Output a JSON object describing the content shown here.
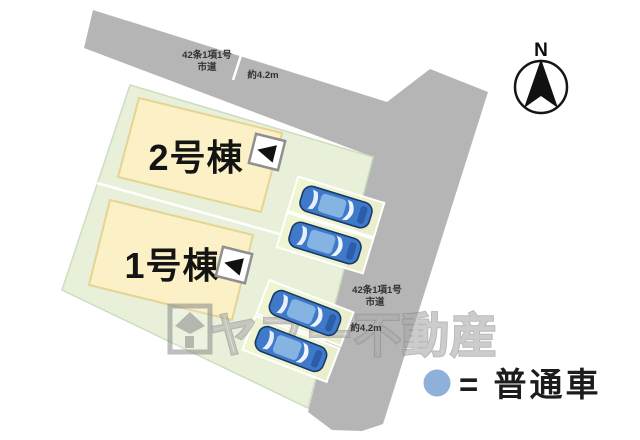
{
  "plan": {
    "buildings": [
      {
        "label": "2号棟"
      },
      {
        "label": "1号棟"
      }
    ],
    "roads": {
      "top": {
        "name_line1": "42条1項1号",
        "name_line2": "市道",
        "width": "約4.2m"
      },
      "right": {
        "name_line1": "42条1項1号",
        "name_line2": "市道",
        "width": "約4.2m"
      }
    },
    "compass": {
      "label": "N"
    },
    "legend": {
      "label": "= 普通車"
    },
    "watermark": {
      "label": "ヤフー不動産"
    },
    "parking": {
      "car_count": 4
    }
  },
  "colors": {
    "road": "#b5b5b6",
    "parcel": "#e8f0da",
    "parcel_border": "#cdddc0",
    "building": "#fbf0c6",
    "building_border": "#e5d492",
    "stall": "#f0f4cf",
    "car_body": "#3f79c9",
    "car_outline": "#1a3a66",
    "car_cabin": "#85b3e2",
    "legend_car": "#8fb0d9",
    "watermark_gray": "#8a8a8a"
  }
}
